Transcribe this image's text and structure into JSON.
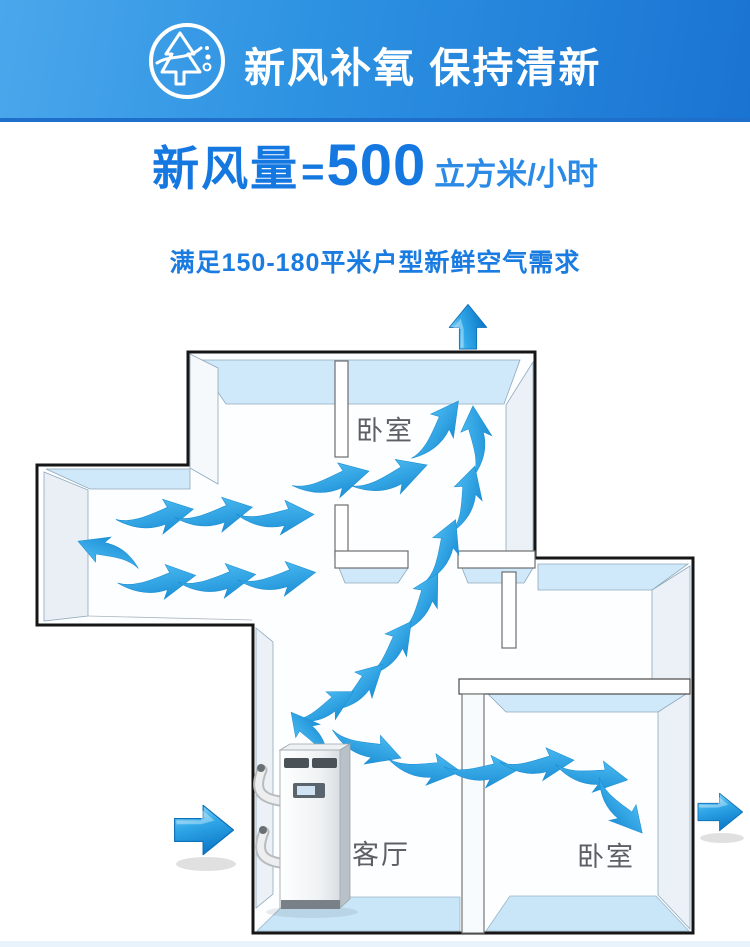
{
  "banner": {
    "title": "新风补氧 保持清新",
    "icon": "pine-tree-circle",
    "bg_gradient": [
      "#4ba7ec",
      "#1a73d2"
    ]
  },
  "headline": {
    "prefix": "新风量",
    "equals": "=",
    "value": "500",
    "unit": "立方米/小时",
    "color": "#1577e0"
  },
  "subtitle": {
    "text": "满足150-180平米户型新鲜空气需求"
  },
  "floorplan": {
    "rooms": [
      {
        "label": "卧室"
      },
      {
        "label": "客厅"
      },
      {
        "label": "卧室"
      }
    ],
    "equipment": "ventilation-unit",
    "air_inlet_side": "left",
    "air_outlet_sides": [
      "top",
      "right"
    ],
    "colors": {
      "outline": "#161616",
      "wall_top": "#cfe8fa",
      "wall_side": "#ebf1f7",
      "floor_strip": "#c9e6f8",
      "airflow_arrow": "#2aa5e6",
      "room_label": "#5c6064"
    }
  }
}
